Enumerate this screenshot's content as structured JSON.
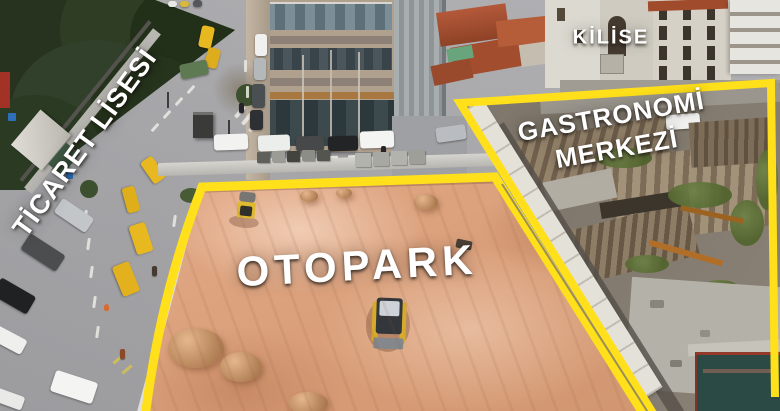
{
  "labels": {
    "school": {
      "text": "TİCARET LİSESİ"
    },
    "church": {
      "text": "KİLİSE"
    },
    "gastronomy": {
      "line1": "GASTRONOMİ",
      "line2": "MERKEZİ"
    },
    "parking": {
      "text": "OTOPARK"
    }
  },
  "colors": {
    "annotation_yellow": "#FFE01A",
    "parking_ground": "#E0A784",
    "street_gray": "#A7A7AA",
    "tree_green": "#2E3B24",
    "ruin_base": "#8C8478",
    "roof_red": "#A24E2E"
  }
}
